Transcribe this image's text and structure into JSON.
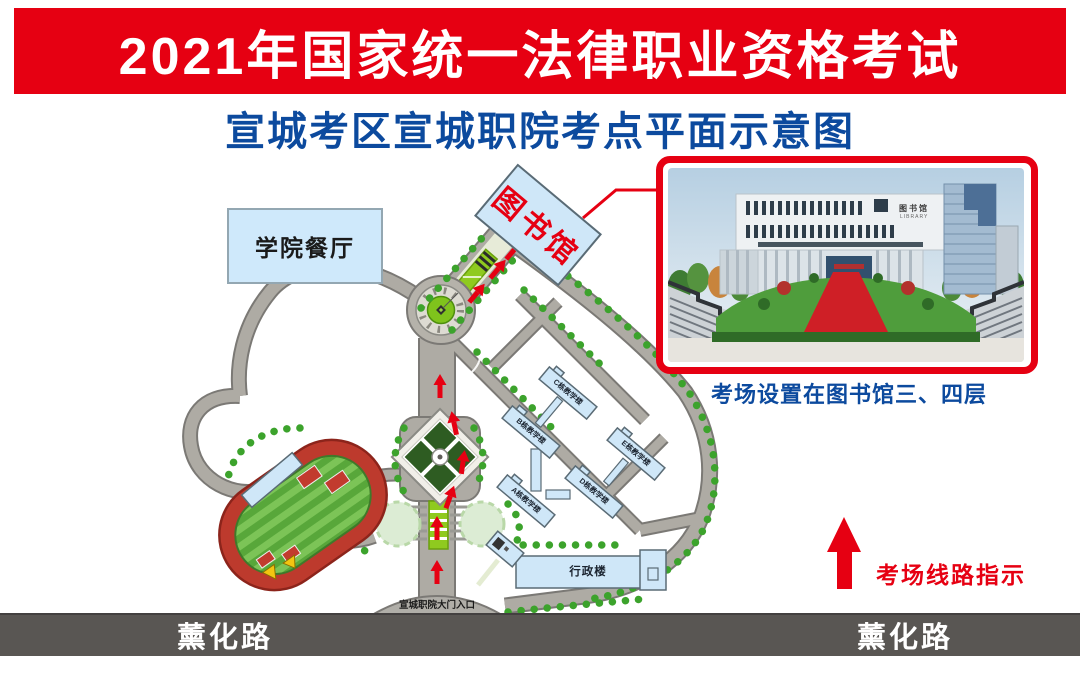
{
  "banner": {
    "title": "2021年国家统一法律职业资格考试"
  },
  "subtitle": "宣城考区宣城职院考点平面示意图",
  "map": {
    "cafeteria": "学院餐厅",
    "library": "图书馆",
    "gate": "宣城职院大门入口",
    "admin": "行政楼",
    "buildings": [
      {
        "label": "A栋教学楼"
      },
      {
        "label": "B栋教学楼"
      },
      {
        "label": "C栋教学楼"
      },
      {
        "label": "D栋教学楼"
      },
      {
        "label": "E栋教学楼"
      }
    ],
    "street_left": "薰化路",
    "street_right": "薰化路"
  },
  "photo": {
    "caption": "考场设置在图书馆三、四层",
    "sign": "图书馆",
    "sign_sub": "LIBRARY"
  },
  "legend": {
    "route": "考场线路指示"
  },
  "colors": {
    "banner_red": "#e60012",
    "title_blue": "#0c4a9e",
    "building_blue": "#cfe7f8",
    "road_gray": "#aeaba4",
    "street_gray": "#595653",
    "route_red": "#e60012",
    "tree_green": "#3ca32c"
  }
}
